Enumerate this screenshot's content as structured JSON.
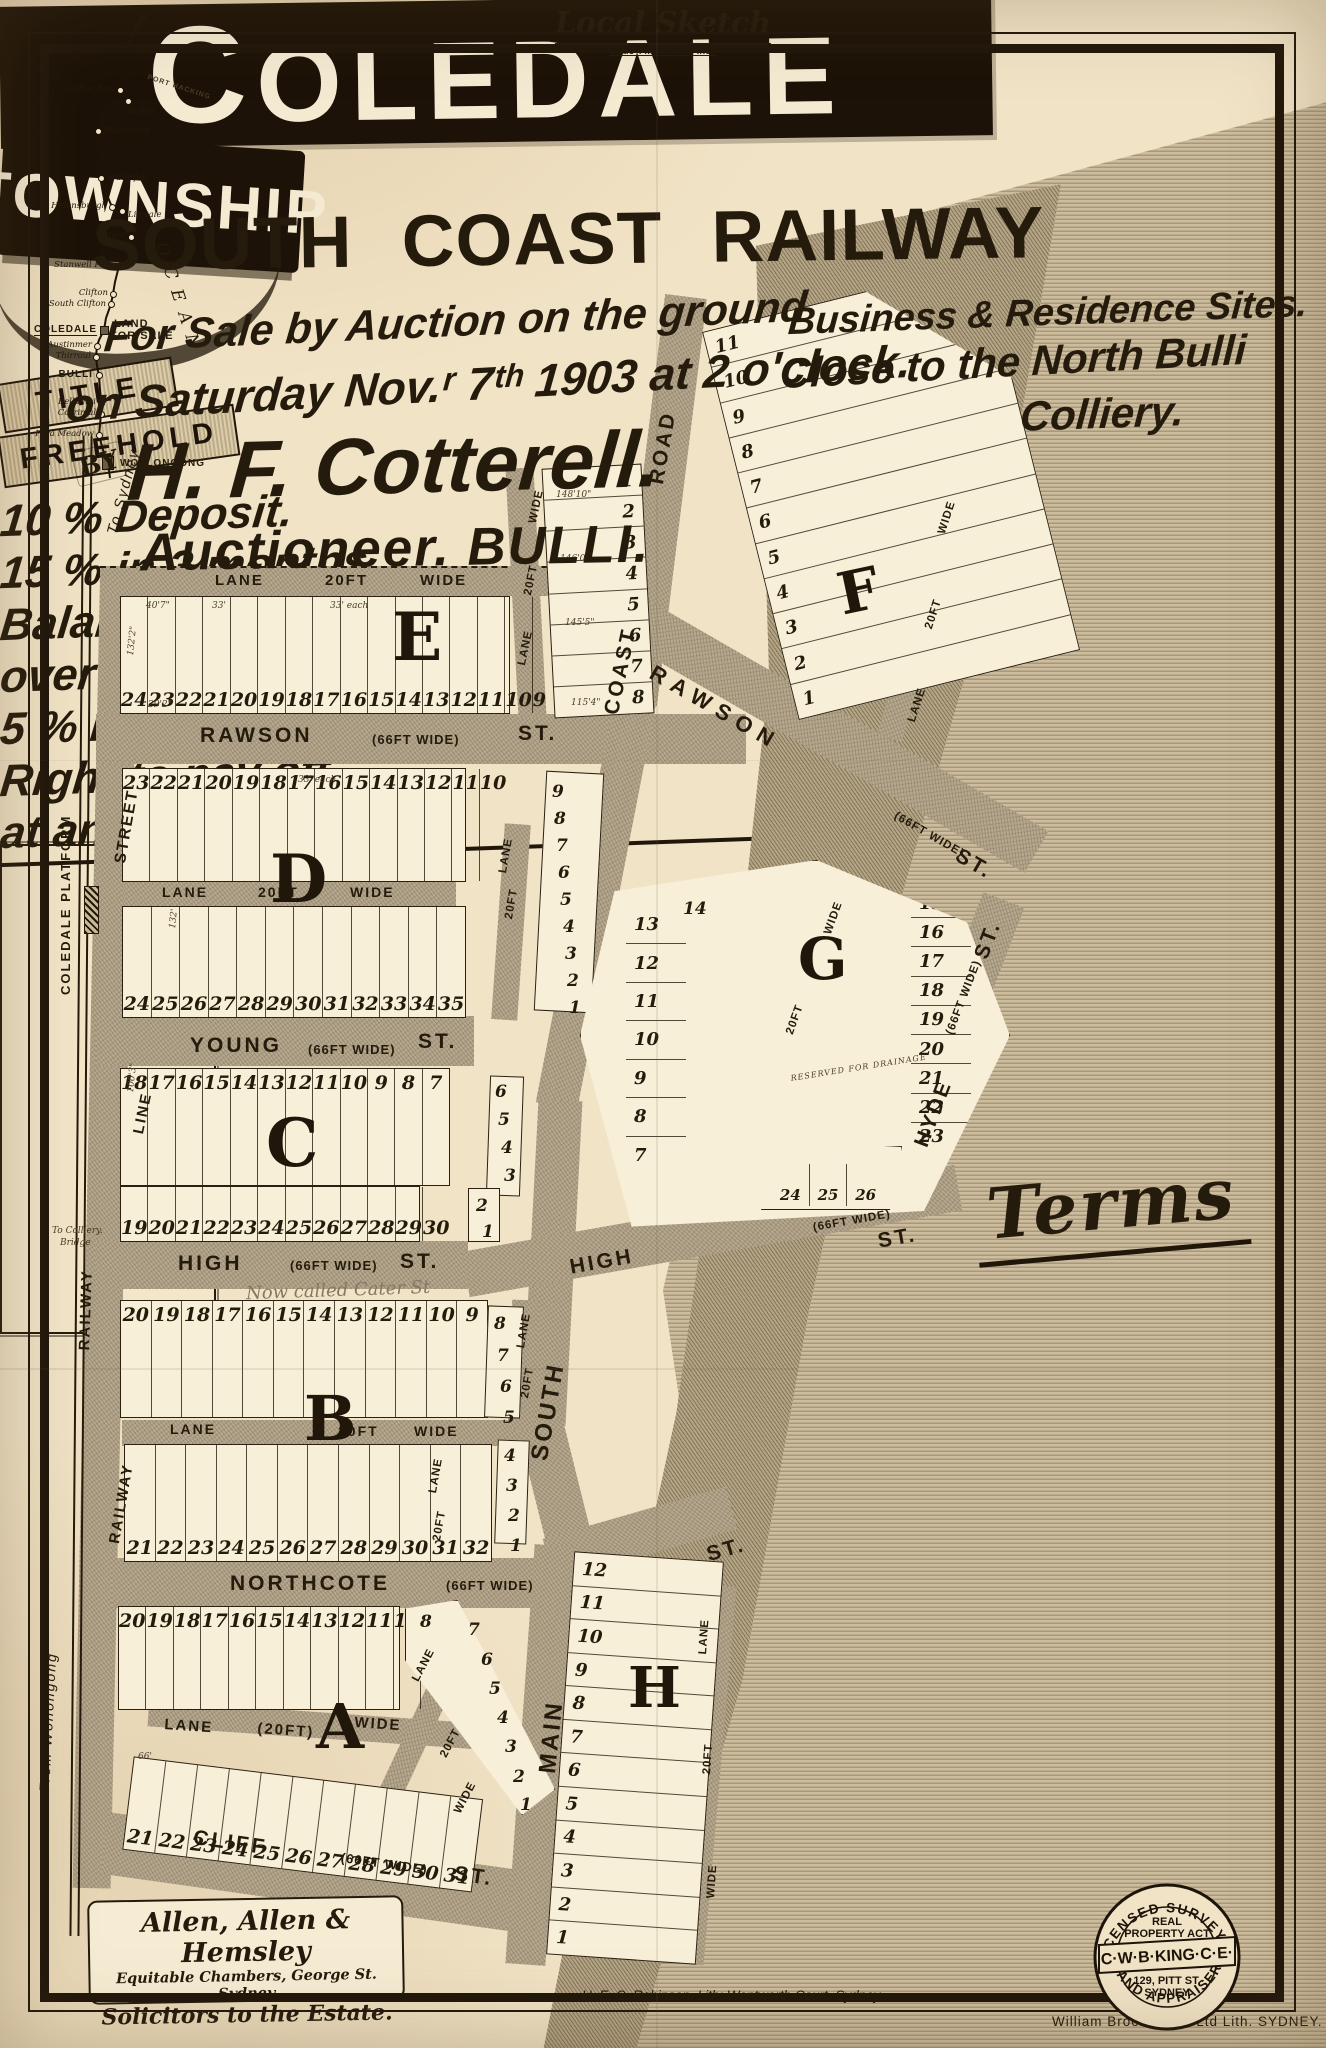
{
  "poster": {
    "title": "COLEDALE",
    "ribbon": "TOWNSHIP",
    "subtitle": "SOUTH COAST RAILWAY",
    "auction_line1": "For Sale by Auction on the ground",
    "auction_line2": "on Saturday Nov.ʳ 7ᵗʰ 1903 at 2 o'clock.",
    "sites_line1": "Business & Residence Sites.",
    "sites_line2": "Close to the North Bulli",
    "sites_line3": "Colliery.",
    "by_label": "BY",
    "auctioneer": "H. F. Cotterell.",
    "auctioneer_sub": "Auctioneer. BULLI.",
    "title_word": "TITLE",
    "freehold_word": "FREEHOLD"
  },
  "terms": {
    "heading": "Terms",
    "line1": "10 % Deposit.",
    "line2": "15 % in 3 months.",
    "line3": "Balance  extending",
    "line4": "over 3 years with",
    "line5": "5 % Interest.",
    "line6": "Right to pay off",
    "line7": "at any time."
  },
  "local_sketch": {
    "title": "Local Sketch",
    "scale_note": "Scale 4 miles to an inch",
    "ocean": "OCEAN",
    "port_hacking": "PORT HACKING",
    "to_sydney": "To Sydney",
    "land_for_sale_1": "LAND",
    "land_for_sale_2": "FOR SALE",
    "stations": [
      "Loftus Jun.",
      "Loftus",
      "Heathcote",
      "Waterfall",
      "Helensburgh",
      "Lilyvale",
      "Otford",
      "Stanwell Park",
      "Clifton",
      "South Clifton",
      "COLEDALE",
      "Austinmer",
      "Thirroul",
      "BULLI",
      "Bellambi",
      "Corrimal",
      "Para Meadow",
      "WOLLONGONG"
    ]
  },
  "map": {
    "names": {
      "rawson": "RAWSON",
      "young": "YOUNG",
      "high": "HIGH",
      "northcote": "NORTHCOTE",
      "cliff": "CLIFF",
      "south": "SOUTH",
      "coast": "COAST",
      "road": "ROAD",
      "main": "MAIN",
      "hyde": "HYDE",
      "st": "ST.",
      "lane": "LANE",
      "ft20": "20FT",
      "ft20p": "(20FT)",
      "wide": "WIDE",
      "wide66": "(66FT WIDE)"
    },
    "railway": {
      "to_sydney": "To Sydney",
      "line": "LINE",
      "street": "STREET",
      "platform": "COLEDALE PLATFORM",
      "railway": "RAILWAY",
      "from_wollongong": "From Wollongong",
      "colliery_note": "To Colliery.",
      "bridge": "Bridge"
    },
    "annotations": {
      "cater": "Now called Cater St",
      "drainage": "RESERVED FOR DRAINAGE"
    },
    "dims": [
      "40'7\"",
      "33'",
      "33' each",
      "132'2\"",
      "29'2\"",
      "148'10\"",
      "146'0\"",
      "145'5\"",
      "115'4\"",
      "33' each",
      "132'",
      "100'3\"",
      "66'"
    ],
    "blocks": {
      "E": {
        "letter": "E",
        "lots": [
          "24",
          "23",
          "22",
          "21",
          "20",
          "19",
          "18",
          "17",
          "16",
          "15",
          "14",
          "13",
          "12",
          "11",
          "10",
          "9"
        ]
      },
      "E_strip": {
        "lots": [
          "1",
          "2",
          "3",
          "4",
          "5",
          "6",
          "7",
          "8"
        ]
      },
      "F": {
        "letter": "F",
        "lots": [
          "11",
          "10",
          "9",
          "8",
          "7",
          "6",
          "5",
          "4",
          "3",
          "2",
          "1"
        ]
      },
      "D": {
        "letter": "D",
        "row_top": [
          "23",
          "22",
          "21",
          "20",
          "19",
          "18",
          "17",
          "16",
          "15",
          "14",
          "13",
          "12",
          "11",
          "10"
        ],
        "row_bottom": [
          "24",
          "25",
          "26",
          "27",
          "28",
          "29",
          "30",
          "31",
          "32",
          "33",
          "34",
          "35"
        ],
        "col_right": [
          "9",
          "8",
          "7",
          "6",
          "5",
          "4",
          "3",
          "2",
          "1"
        ]
      },
      "C": {
        "letter": "C",
        "row_top": [
          "18",
          "17",
          "16",
          "15",
          "14",
          "13",
          "12",
          "11",
          "10",
          "9",
          "8",
          "7"
        ],
        "row_bottom": [
          "19",
          "20",
          "21",
          "22",
          "23",
          "24",
          "25",
          "26",
          "27",
          "28",
          "29",
          "30"
        ],
        "col_right": [
          "6",
          "5",
          "4",
          "3",
          "2",
          "1"
        ]
      },
      "B": {
        "letter": "B",
        "row_top": [
          "20",
          "19",
          "18",
          "17",
          "16",
          "15",
          "14",
          "13",
          "12",
          "11",
          "10",
          "9"
        ],
        "col_right_top": [
          "8",
          "7",
          "6",
          "5"
        ],
        "row_bottom": [
          "21",
          "22",
          "23",
          "24",
          "25",
          "26",
          "27",
          "28",
          "29",
          "30",
          "31",
          "32"
        ],
        "col_right_bottom": [
          "4",
          "3",
          "2",
          "1"
        ]
      },
      "A": {
        "letter": "A",
        "row_top": [
          "20",
          "19",
          "18",
          "17",
          "16",
          "15",
          "14",
          "13",
          "12",
          "11",
          "10",
          "9"
        ],
        "col_right": [
          "8",
          "7",
          "6",
          "5",
          "4",
          "3",
          "2",
          "1"
        ],
        "row_bottom": [
          "21",
          "22",
          "23",
          "24",
          "25",
          "26",
          "27",
          "28",
          "29",
          "30",
          "31"
        ]
      },
      "G": {
        "letter": "G",
        "num_14": "14",
        "col_west": [
          "13",
          "12",
          "11",
          "10",
          "9",
          "8",
          "7"
        ],
        "col_east": [
          "15",
          "16",
          "17",
          "18",
          "19",
          "20",
          "21",
          "22",
          "23"
        ],
        "row_south": [
          "24",
          "25",
          "26"
        ]
      },
      "H": {
        "letter": "H",
        "lots": [
          "12",
          "11",
          "10",
          "9",
          "8",
          "7",
          "6",
          "5",
          "4",
          "3",
          "2",
          "1"
        ]
      }
    }
  },
  "footer": {
    "solicitors_line1": "Allen, Allen & Hemsley",
    "solicitors_line2": "Equitable Chambers, George St. Sydney",
    "solicitors_line3": "Solicitors to the Estate.",
    "lith": "H. E. C. Robinson. Lith: Wentworth Court, Sydney.",
    "printer": "William Brooks & Cº Ltd Lith.  SYDNEY.",
    "stamp": {
      "arc_top": "LICENSED SURVEYOR",
      "real1": "REAL",
      "real2": "PROPERTY ACT",
      "banner": "C·W·B·KING·C·E·",
      "addr1": "129, PITT ST.",
      "addr2": "SYDNEY",
      "arc_bottom": "LAND APPRAISER"
    }
  }
}
